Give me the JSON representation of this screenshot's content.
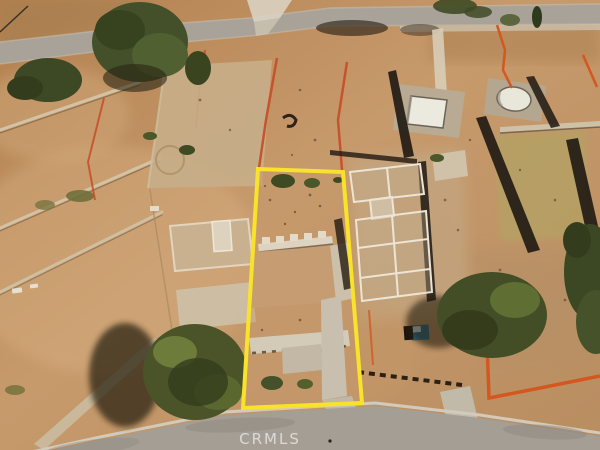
{
  "image": {
    "kind": "aerial-drone-photo",
    "description": "Aerial view of graded vacant hillside residential lots (post-fire cleared parcels) between two streets, with one parcel outlined in yellow and an MLS watermark on the lower street"
  },
  "watermark": {
    "text": "CRMLS",
    "color": "rgba(255,255,255,0.55)"
  },
  "highlight": {
    "label": "subject parcel boundary",
    "color": "#f9e32a",
    "stroke_width": "4"
  },
  "colors": {
    "dirt": "#c1925f",
    "dirt_light": "#d8b183",
    "dirt_pad": "#c7ae8a",
    "road": "#a49e94",
    "curb": "#d2cabb",
    "concrete": "#d3cab8",
    "foundation_white": "#ece4d4",
    "tree_green": "#44502a",
    "tree_dark": "#333d1e",
    "shadow": "#241b0e",
    "orange_fence": "#cd5526",
    "pool_white": "#eceade",
    "porta_potty_blue": "#2e6f8e",
    "watermark": "rgba(255,255,255,0.55)"
  },
  "scene": {
    "elements": [
      "top street with trees",
      "left terraced vacant lots",
      "graded dirt pad lot",
      "yellow-outlined subject lot with concrete foundation and driveway",
      "neighbor lot with white foundation footings",
      "burned walls with long shadows",
      "two empty swimming pools",
      "orange silt fencing",
      "blue portable toilet",
      "bottom street with watermark"
    ]
  }
}
